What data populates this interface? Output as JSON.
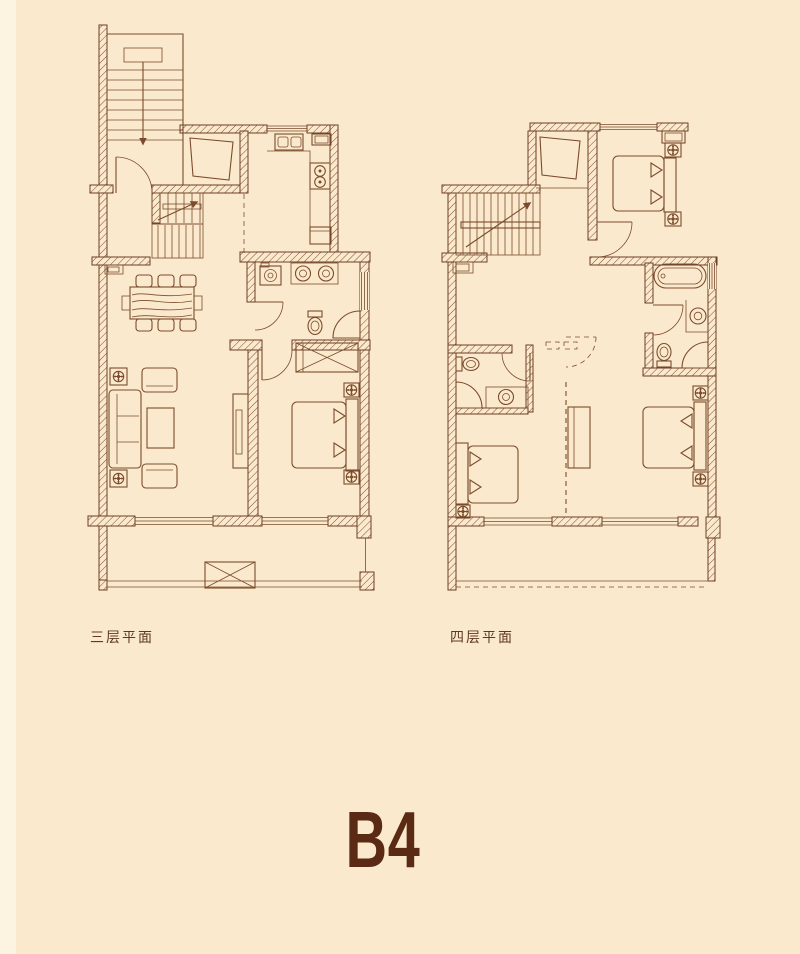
{
  "page": {
    "background_color": "#fbe9ce",
    "wall_line_color": "#6b4026",
    "furniture_line_color": "#7b4c2c",
    "label_color": "#5e3a22"
  },
  "unit": {
    "label": "B4",
    "color": "#5b2a14"
  },
  "floor_plans": [
    {
      "id": "third-floor",
      "label": "三层平面",
      "symbols": [
        "exterior-staircase",
        "entry-door",
        "interior-staircase",
        "storage-room",
        "kitchen-sink",
        "fridge",
        "stove",
        "counter",
        "washing-machine",
        "double-vanity",
        "toilet",
        "shower",
        "wardrobe",
        "double-bed",
        "nightstand-lamps",
        "tv-cabinet",
        "sofa-set",
        "coffee-table",
        "plants",
        "dining-table-six-chairs",
        "balcony",
        "equipment-platform"
      ]
    },
    {
      "id": "fourth-floor",
      "label": "四层平面",
      "symbols": [
        "interior-staircase",
        "storage-room",
        "double-bed-master",
        "wardrobe-box",
        "nightstand-lamps",
        "bathtub",
        "vanity",
        "toilet",
        "shower",
        "second-bathroom-toilet",
        "second-bathroom-shower",
        "second-bathroom-vanity",
        "bed-left",
        "bed-right",
        "desk-cabinet",
        "dashed-partition",
        "terrace"
      ]
    }
  ]
}
